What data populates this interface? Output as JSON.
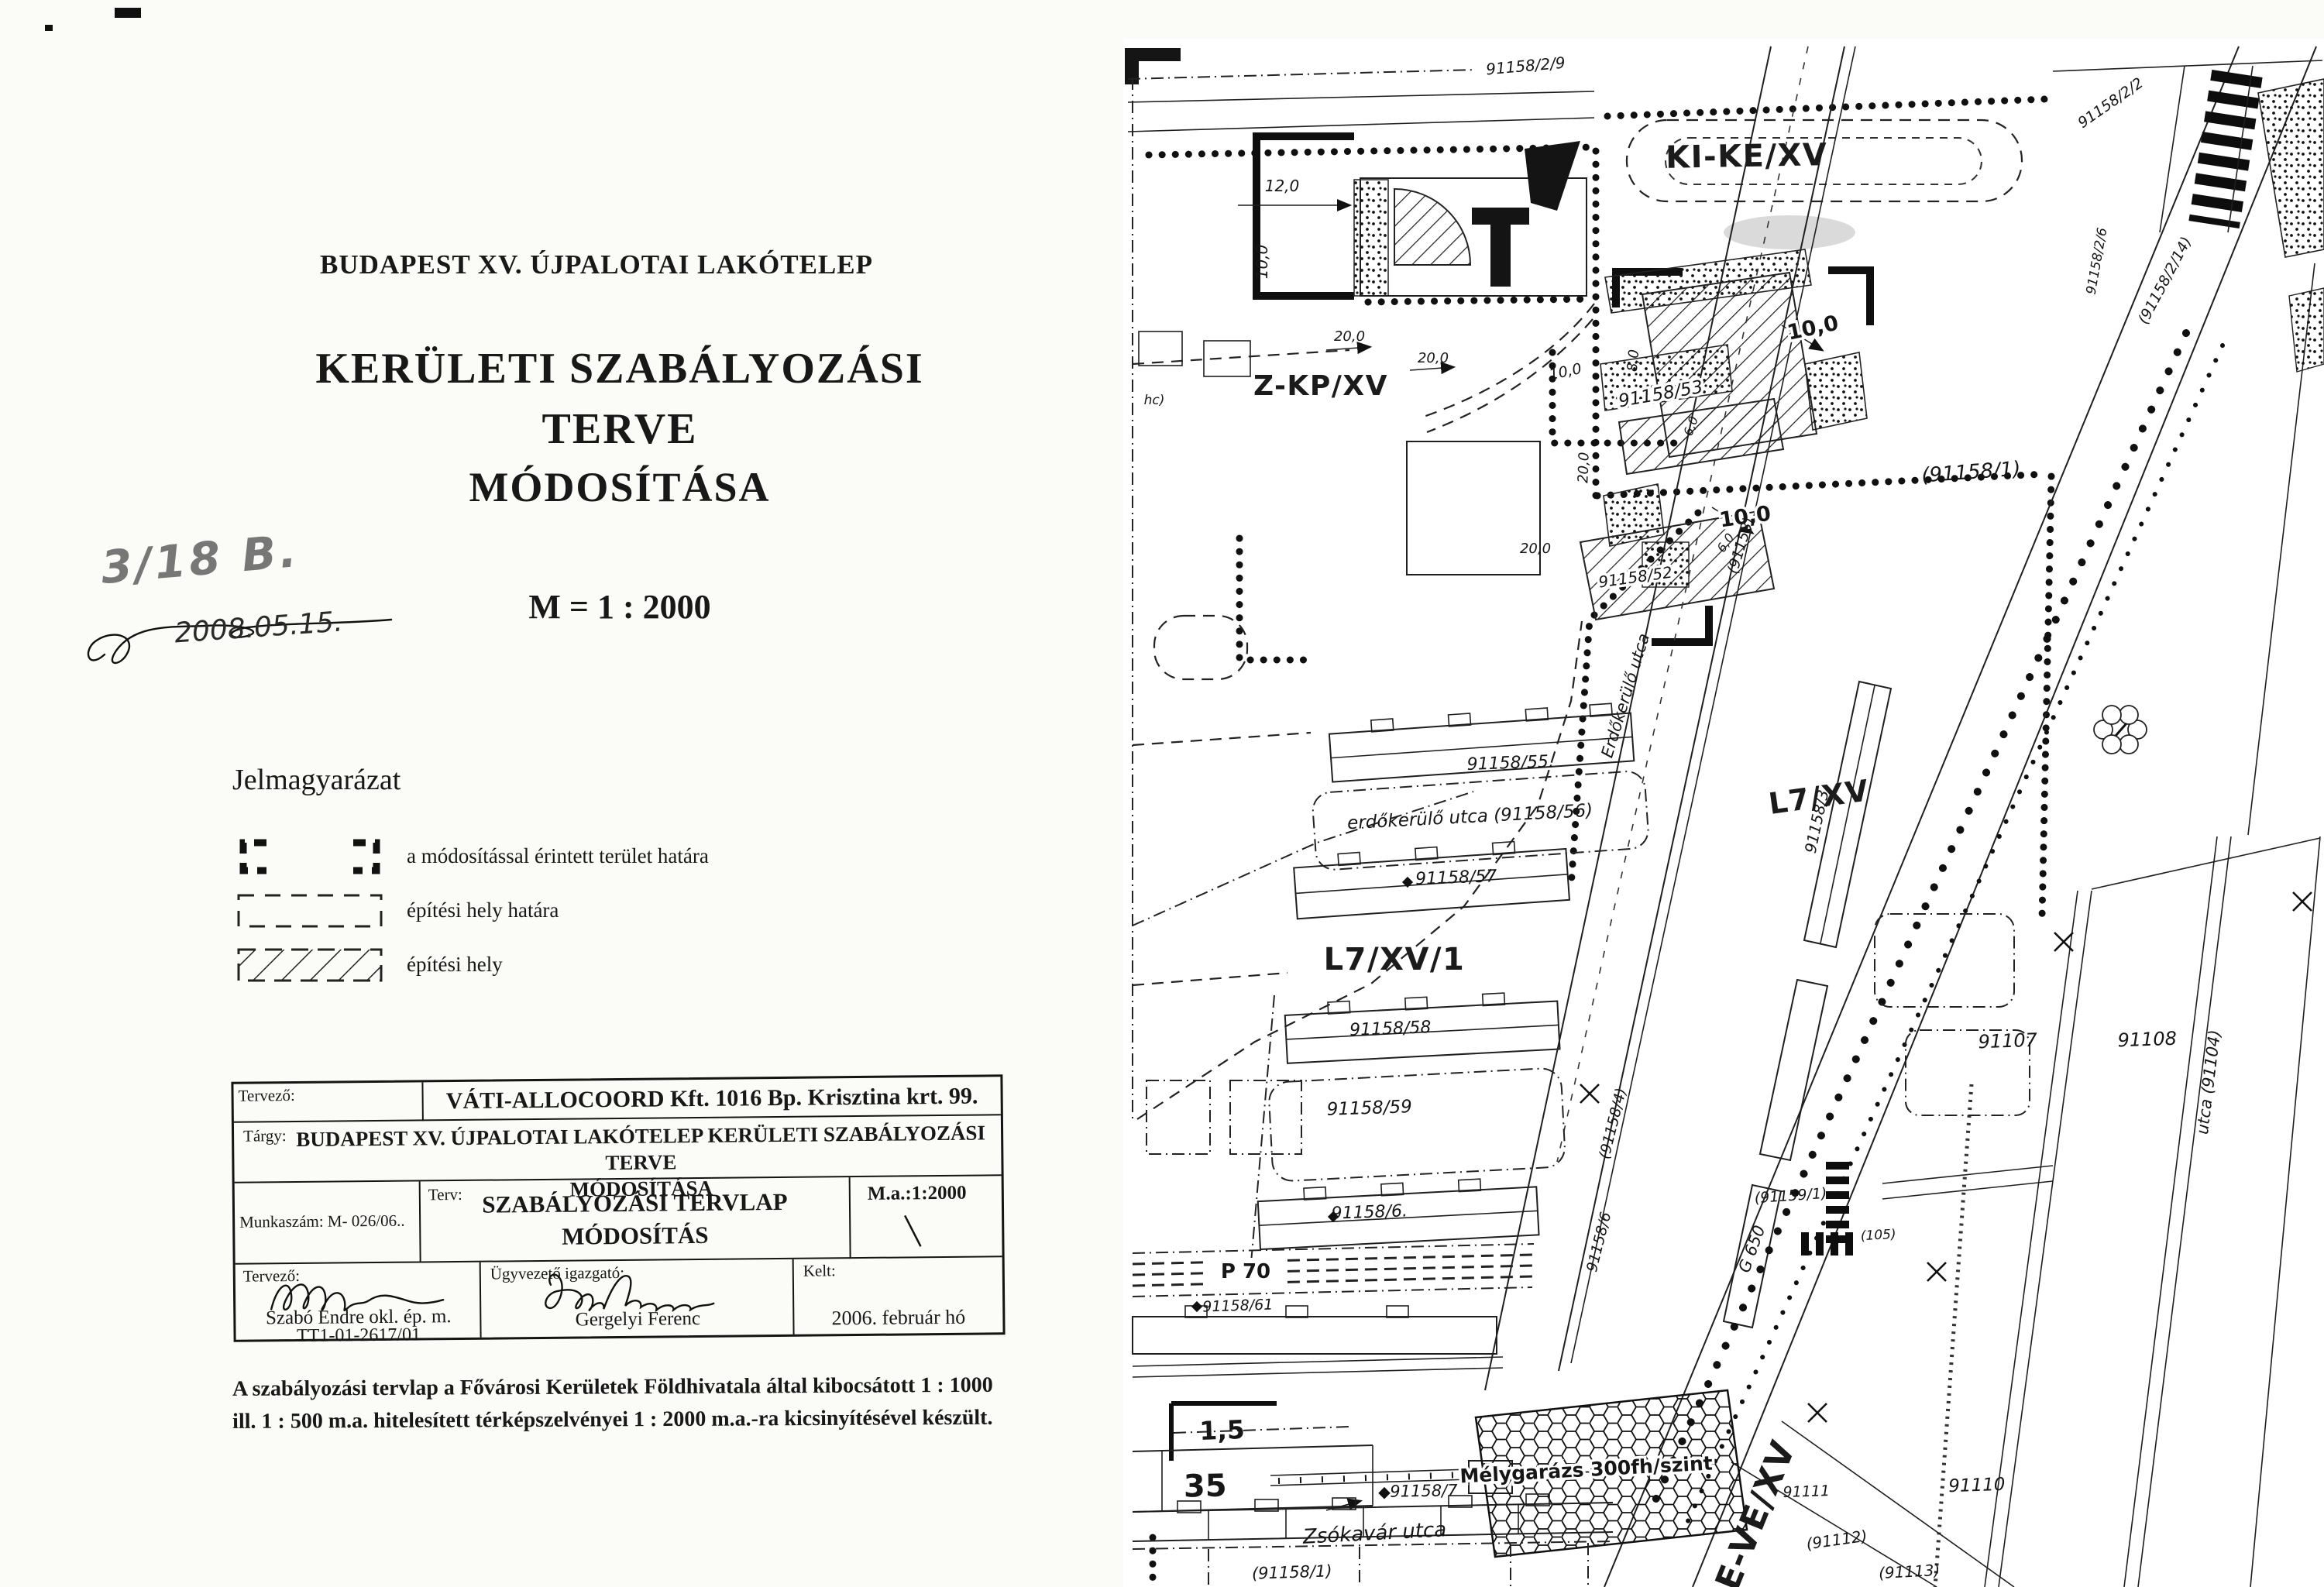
{
  "page": {
    "title_line": "BUDAPEST XV. ÚJPALOTAI LAKÓTELEP",
    "heading1": "KERÜLETI SZABÁLYOZÁSI",
    "heading2": "TERVE",
    "heading3": "MÓDOSÍTÁSA",
    "scale": "M = 1 : 2000",
    "hand_note": "3/18 B.",
    "hand_date": "2008.05.15.",
    "legend": {
      "heading": "Jelmagyarázat",
      "items": [
        {
          "label": "a módosítással érintett terület határa"
        },
        {
          "label": "építési hely határa"
        },
        {
          "label": "építési hely"
        }
      ]
    },
    "titleblock": {
      "r1c1": "Tervező:",
      "r1c2": "VÁTI-ALLOCOORD Kft. 1016 Bp. Krisztina krt. 99.",
      "r2_label": "Tárgy:",
      "r2_text1": "BUDAPEST XV. ÚJPALOTAI LAKÓTELEP KERÜLETI SZABÁLYOZÁSI TERVE",
      "r2_text2": "MÓDOSÍTÁSA",
      "r3c1": "Munkaszám:  M- 026/06..",
      "r3c2_label": "Terv:",
      "r3c2_line1": "SZABÁLYOZÁSI TERVLAP",
      "r3c2_line2": "MÓDOSÍTÁS",
      "r3c3": "M.a.:1:2000",
      "r4c1_label": "Tervező:",
      "r4c1_name": "Szabó Endre okl. ép. m.",
      "r4c1_id": "TT1-01-2617/01",
      "r4c2_label": "Ügyvezető igazgató:",
      "r4c2_name": "Gergelyi Ferenc",
      "r4c3_label": "Kelt:",
      "r4c3_value": "2006. február hó"
    },
    "footnote1": "A szabályozási tervlap a Fővárosi Kerületek Földhivatala által kibocsátott 1 : 1000",
    "footnote2": "ill. 1 : 500 m.a. hitelesített térképszelvényei 1 : 2000 m.a.-ra kicsinyítésével készült."
  },
  "map": {
    "labels": [
      {
        "t": "91158/2/9"
      },
      {
        "t": "12,0"
      },
      {
        "t": "10,0"
      },
      {
        "t": "KI-KE/XV"
      },
      {
        "t": "91158/2/2"
      },
      {
        "t": "(91158/2/14)"
      },
      {
        "t": "91158/2/6"
      },
      {
        "t": "Z-KP/XV"
      },
      {
        "t": "20,0"
      },
      {
        "t": "20,0"
      },
      {
        "t": "10,0"
      },
      {
        "t": "8,0"
      },
      {
        "t": "6,0"
      },
      {
        "t": "20,0"
      },
      {
        "t": "10,0"
      },
      {
        "t": "91158/53"
      },
      {
        "t": "10,0"
      },
      {
        "t": "6,0"
      },
      {
        "t": "20,0"
      },
      {
        "t": "91158/52"
      },
      {
        "t": "(91158/1)"
      },
      {
        "t": "hc)"
      },
      {
        "t": "L7/XV"
      },
      {
        "t": "91158/55."
      },
      {
        "t": "erdőkerülő utca (91158/56)"
      },
      {
        "t": "91158/57"
      },
      {
        "t": "Erdőkerülő utca"
      },
      {
        "t": "(91158)"
      },
      {
        "t": "91158/3"
      },
      {
        "t": "L7/XV/1"
      },
      {
        "t": "91158/58"
      },
      {
        "t": "91158/59"
      },
      {
        "t": "91158/6."
      },
      {
        "t": "(91158/4)"
      },
      {
        "t": "91158/6"
      },
      {
        "t": "P 70"
      },
      {
        "t": "91158/61"
      },
      {
        "t": "1,5"
      },
      {
        "t": "35"
      },
      {
        "t": "Mélygarázs 300fh/szint"
      },
      {
        "t": "Zsókavár utca"
      },
      {
        "t": "91158/7"
      },
      {
        "t": "(91158/1)"
      },
      {
        "t": "E-VE/XV"
      },
      {
        "t": "G 650"
      },
      {
        "t": "(91159/1)"
      },
      {
        "t": "(105)"
      },
      {
        "t": "91107"
      },
      {
        "t": "91108"
      },
      {
        "t": "utca (91104)"
      },
      {
        "t": "91110"
      },
      {
        "t": "91111"
      },
      {
        "t": "(91112)"
      },
      {
        "t": "(91113)"
      }
    ]
  }
}
